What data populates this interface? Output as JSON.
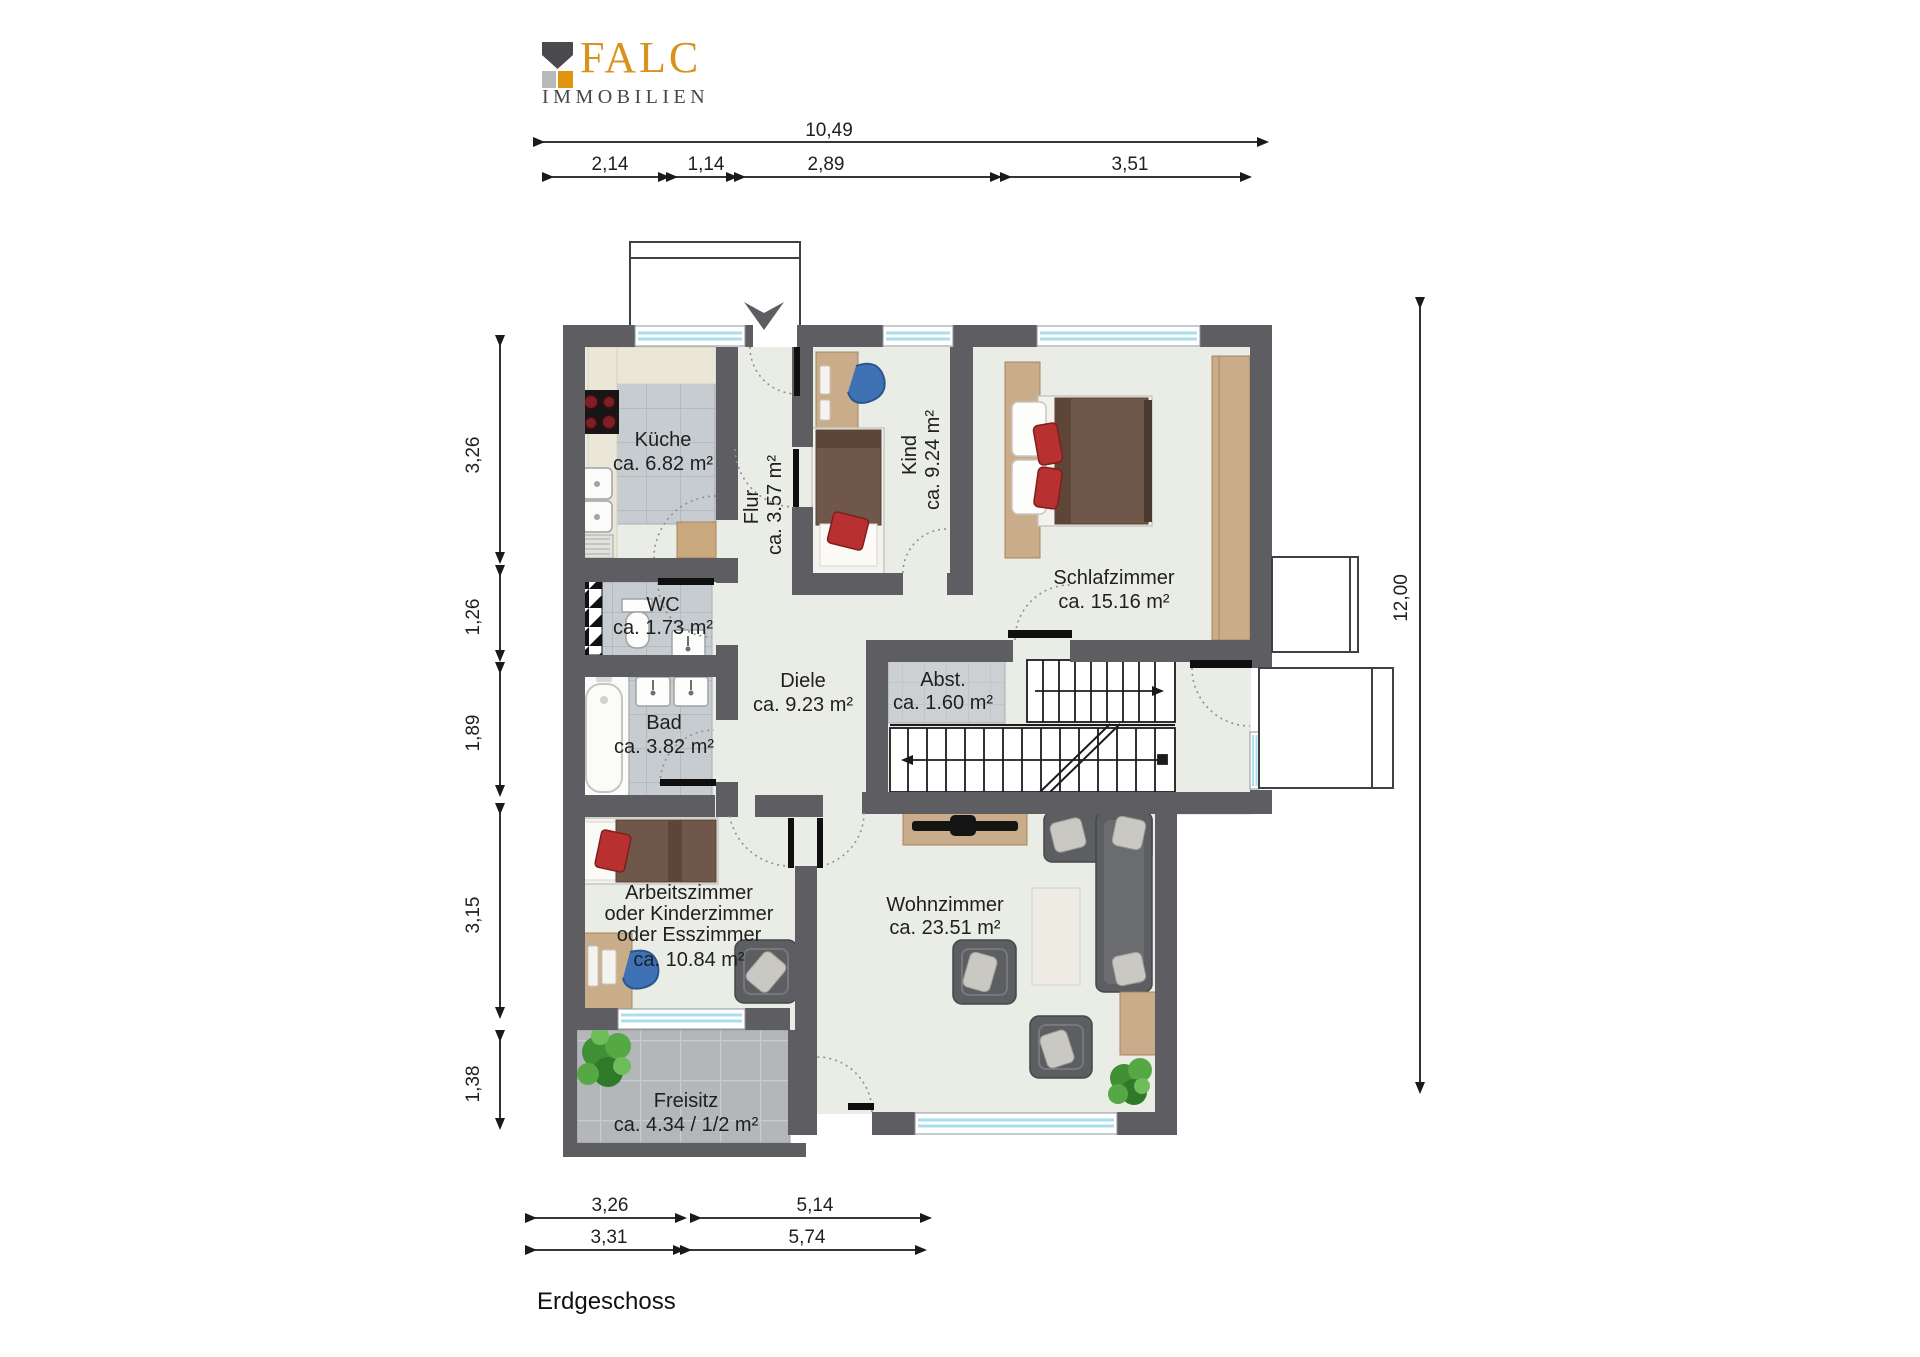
{
  "logo": {
    "brand": "FALC",
    "subtitle": "IMMOBILIEN"
  },
  "floor_label": "Erdgeschoss",
  "dimensions": {
    "top_total": "10,49",
    "top_segments": [
      "2,14",
      "1,14",
      "2,89",
      "3,51"
    ],
    "left_segments": [
      "3,26",
      "1,26",
      "1,89",
      "3,15",
      "1,38"
    ],
    "right_total": "12,00",
    "bottom_row1": [
      "3,26",
      "5,14"
    ],
    "bottom_row2": [
      "3,31",
      "5,74"
    ]
  },
  "rooms": {
    "kueche": {
      "name": "Küche",
      "area": "ca. 6.82 m²"
    },
    "wc": {
      "name": "WC",
      "area": "ca. 1.73 m²"
    },
    "bad": {
      "name": "Bad",
      "area": "ca. 3.82 m²"
    },
    "flur": {
      "name": "Flur",
      "area": "ca. 3.57 m²"
    },
    "kind": {
      "name": "Kind",
      "area": "ca. 9.24 m²"
    },
    "schlafzimmer": {
      "name": "Schlafzimmer",
      "area": "ca. 15.16 m²"
    },
    "diele": {
      "name": "Diele",
      "area": "ca. 9.23 m²"
    },
    "abstellraum": {
      "name": "Abst.",
      "area": "ca. 1.60 m²"
    },
    "arbeitszimmer": {
      "name": "Arbeitszimmer",
      "alt1": "oder Kinderzimmer",
      "alt2": "oder Esszimmer",
      "area": "ca. 10.84 m²"
    },
    "wohnzimmer": {
      "name": "Wohnzimmer",
      "area": "ca. 23.51 m²"
    },
    "freisitz": {
      "name": "Freisitz",
      "area": "ca. 4.34 / 1/2 m²"
    }
  },
  "colors": {
    "wall": "#5d5d62",
    "floor": "#eaece6",
    "tile": "#c7ccd0",
    "window_glass": "#c8ecf4",
    "accent_orange": "#d8931f"
  }
}
